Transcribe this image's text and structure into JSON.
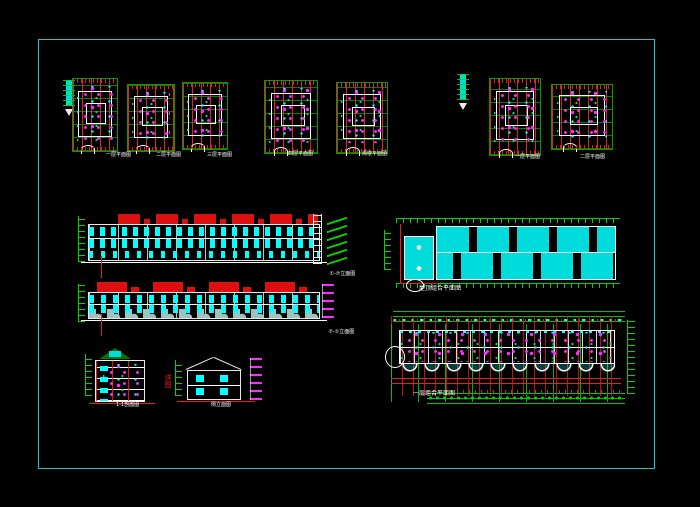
{
  "sheet": {
    "background": "#000000",
    "frame_color": "#1dc7c7",
    "description": "Residential building architectural CAD sheet: unit floor plans (top), front and rear street elevations (left), roof combined plan and ground-floor combined plan (right), section and side elevation (bottom left)"
  },
  "palette": {
    "grid_green": "#00d400",
    "axis_red": "#ef1a1a",
    "detail_cyan": "#00ffff",
    "annotation_magenta": "#ff2cff",
    "line_white": "#ffffff",
    "roof_red": "#dd0f0f",
    "roof_fill": "#00dcdc",
    "label_underline": "#00e0e0"
  },
  "labels": {
    "plans": [
      "一层平面图",
      "二层平面图",
      "三层平面图",
      "四层平面图",
      "阁楼平面图",
      "一层平面图",
      "二层平面图"
    ],
    "elevation_front": "①-⑦立面图",
    "elevation_rear": "⑦-①立面图",
    "roof_plan": "屋顶组合平面图",
    "combined_plan": "一层组合平面图",
    "section": "1-1剖面图",
    "side_elevation": "侧立面图",
    "red_note": "详图"
  }
}
